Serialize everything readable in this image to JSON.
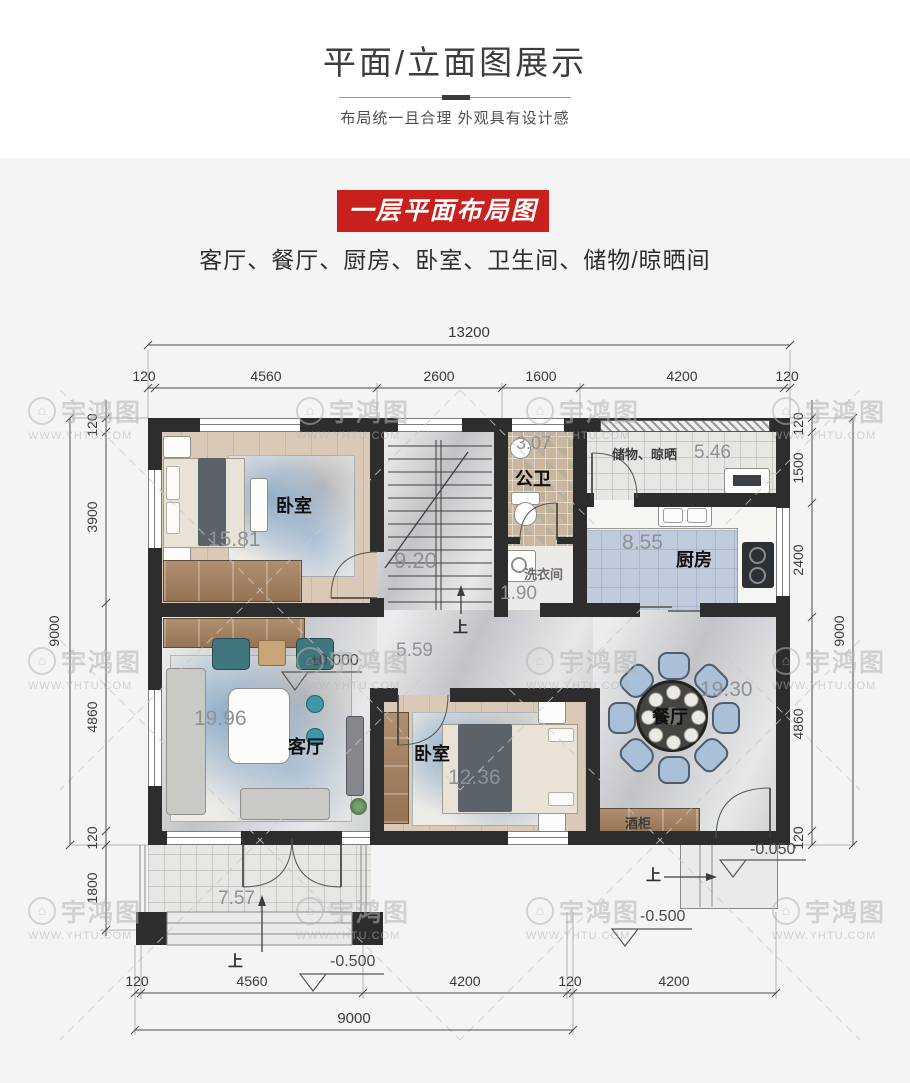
{
  "header": {
    "title": "平面/立面图展示",
    "subtitle": "布局统一且合理 外观具有设计感"
  },
  "banner": {
    "label": "一层平面布局图",
    "color": "#c9201d"
  },
  "intro": {
    "room_list": "客厅、餐厅、厨房、卧室、卫生间、储物/晾晒间"
  },
  "watermark": {
    "brand": "宇鸿图",
    "url": "WWW.YHTU.COM"
  },
  "plan": {
    "rooms": {
      "bedroom1": {
        "name": "卧室",
        "area": "15.81"
      },
      "bedroom2": {
        "name": "卧室",
        "area": "12.36"
      },
      "living": {
        "name": "客厅",
        "area": "19.96"
      },
      "dining": {
        "name": "餐厅",
        "area": "19.30"
      },
      "kitchen": {
        "name": "厨房",
        "area": "8.55"
      },
      "bath": {
        "name": "公卫",
        "area": "3.07"
      },
      "laundry": {
        "name": "洗衣间",
        "area": "1.90"
      },
      "storage": {
        "name": "储物、晾晒",
        "area": "5.46"
      },
      "stair": {
        "area": "9.20"
      },
      "hall": {
        "area": "5.59"
      },
      "porch": {
        "area": "7.57"
      },
      "wine_cabinet": {
        "name": "酒柜"
      }
    },
    "levels": {
      "ground": "±0.000",
      "entry": "-0.050",
      "outdoor": "-0.500"
    },
    "stair_up": "上",
    "dims": {
      "top_total": "13200",
      "top": [
        "120",
        "4560",
        "2600",
        "1600",
        "4200",
        "120"
      ],
      "left_total": "9000",
      "left": [
        "120",
        "3900",
        "4860",
        "120",
        "1800"
      ],
      "right_total": "9000",
      "right": [
        "120",
        "1500",
        "2400",
        "4860",
        "120"
      ],
      "bottom": [
        "120",
        "4560",
        "4200",
        "120",
        "4200"
      ],
      "bottom_total": "9000"
    }
  }
}
